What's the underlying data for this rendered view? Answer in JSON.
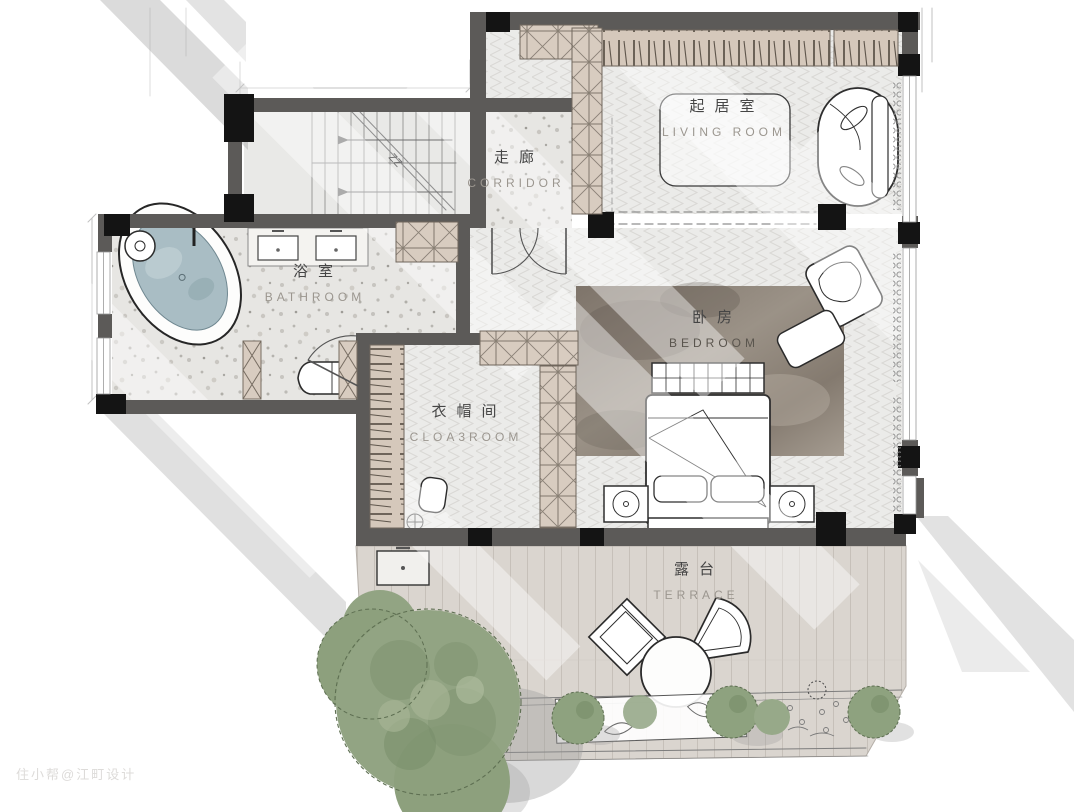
{
  "watermark": "住小帮@江町设计",
  "rooms": {
    "corridor": {
      "zh": "走廊",
      "en": "CORRIDOR"
    },
    "living_room": {
      "zh": "起居室",
      "en": "LIVING ROOM"
    },
    "bathroom": {
      "zh": "浴室",
      "en": "BATHROOM"
    },
    "bedroom": {
      "zh": "卧房",
      "en": "BEDROOM"
    },
    "cloakroom": {
      "zh": "衣帽间",
      "en": "CLOA3ROOM"
    },
    "terrace": {
      "zh": "露台",
      "en": "TERRACE"
    }
  },
  "stairs": {
    "break_mark": "ZZ"
  },
  "colors": {
    "wall": "#5c5a58",
    "column": "#141414",
    "cabinet": "#d8ccc0",
    "floor_wood": "#ebebe9",
    "floor_stone": "#e7e6e3",
    "deck": "#dad5cf",
    "rug_dark": "#8d8379",
    "water": "#a9bdc4",
    "plant": "#92a483"
  }
}
